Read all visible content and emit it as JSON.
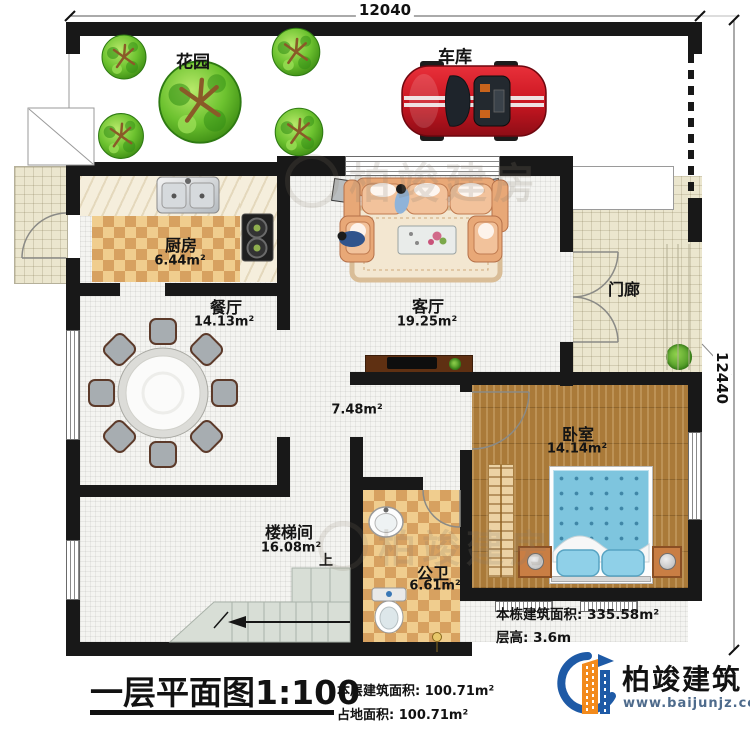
{
  "dimensions": {
    "top_width": "12040",
    "right_height": "12440"
  },
  "rooms": {
    "garden": {
      "label": "花园"
    },
    "garage": {
      "label": "车库"
    },
    "kitchen": {
      "label": "厨房",
      "area": "6.44m²"
    },
    "dining": {
      "label": "餐厅",
      "area": "14.13m²"
    },
    "living": {
      "label": "客厅",
      "area": "19.25m²"
    },
    "porch": {
      "label": "门廊"
    },
    "hallway": {
      "area": "7.48m²"
    },
    "bedroom": {
      "label": "卧室",
      "area": "14.14m²"
    },
    "stairwell": {
      "label": "楼梯间",
      "area": "16.08m²",
      "up": "上"
    },
    "bathroom": {
      "label": "公卫",
      "area": "6.61m²"
    }
  },
  "footer": {
    "plan_title": "一层平面图",
    "plan_scale": "1:100",
    "floor_area_label": "本层建筑面积: ",
    "floor_area_value": "100.71m²",
    "land_area_label": "占地面积: ",
    "land_area_value": "100.71m²"
  },
  "building_info": {
    "total_area_label": "本栋建筑面积: ",
    "total_area_value": "335.58m²",
    "floor_height_label": "层高: ",
    "floor_height_value": "3.6m"
  },
  "branding": {
    "company": "柏竣建筑",
    "website": "www.baijunjz.com"
  },
  "watermark": {
    "text": "柏竣建房"
  },
  "colors": {
    "wall": "#181818",
    "checker": "#d7a160",
    "wood_floor": "#aa7a39",
    "bed": "#7ec5de",
    "car": "#cc1722",
    "logo_blue": "#1e5aa6",
    "logo_orange": "#f28a1c"
  }
}
